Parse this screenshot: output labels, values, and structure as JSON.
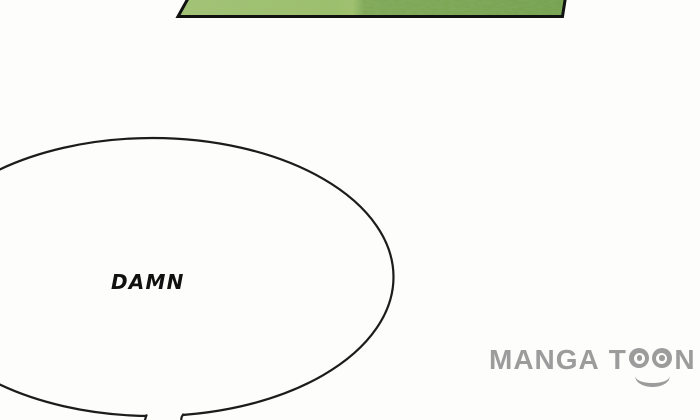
{
  "speech_bubble": {
    "text": "DAMN"
  },
  "watermark": {
    "full_text": "MANGATOON",
    "part_manga": "MANGA",
    "part_t": "T",
    "part_n": "N",
    "eye_icon": "circled-dot-eye",
    "smile_icon": "smile-arc"
  },
  "colors": {
    "background": "#fdfdfc",
    "grass_light": "#9ebf6b",
    "grass_dark": "#78a350",
    "panel_border": "#111111",
    "bubble_outline": "#1c1c1c",
    "watermark_gray": "#9c9c9c"
  }
}
